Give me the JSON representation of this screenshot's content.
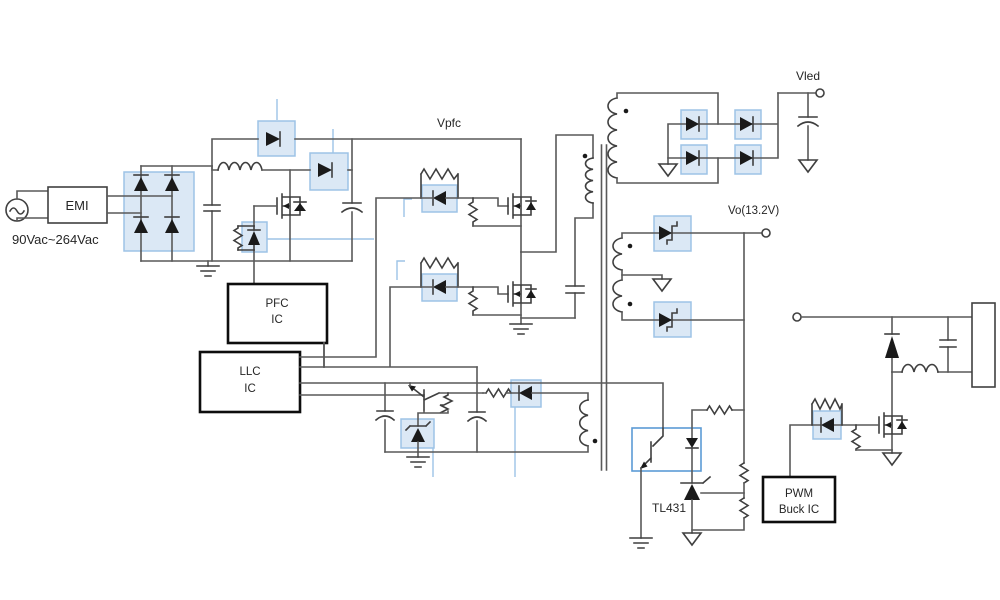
{
  "colors": {
    "wire": "#595959",
    "component": "#3f3f3f",
    "highlight_fill": "#dbe8f5",
    "highlight_stroke": "#9dc3e6",
    "ic_border": "#0d0d0d",
    "background": "#ffffff"
  },
  "labels": {
    "ac_input_range": "90Vac~264Vac",
    "emi_filter": "EMI",
    "pfc_bus": "Vpfc",
    "led_output": "Vled",
    "main_output": "Vo(13.2V)",
    "pfc_controller": {
      "line1": "PFC",
      "line2": "IC"
    },
    "llc_controller": {
      "line1": "LLC",
      "line2": "IC"
    },
    "shunt_regulator": "TL431",
    "buck_controller": {
      "line1": "PWM",
      "line2": "Buck IC"
    }
  }
}
